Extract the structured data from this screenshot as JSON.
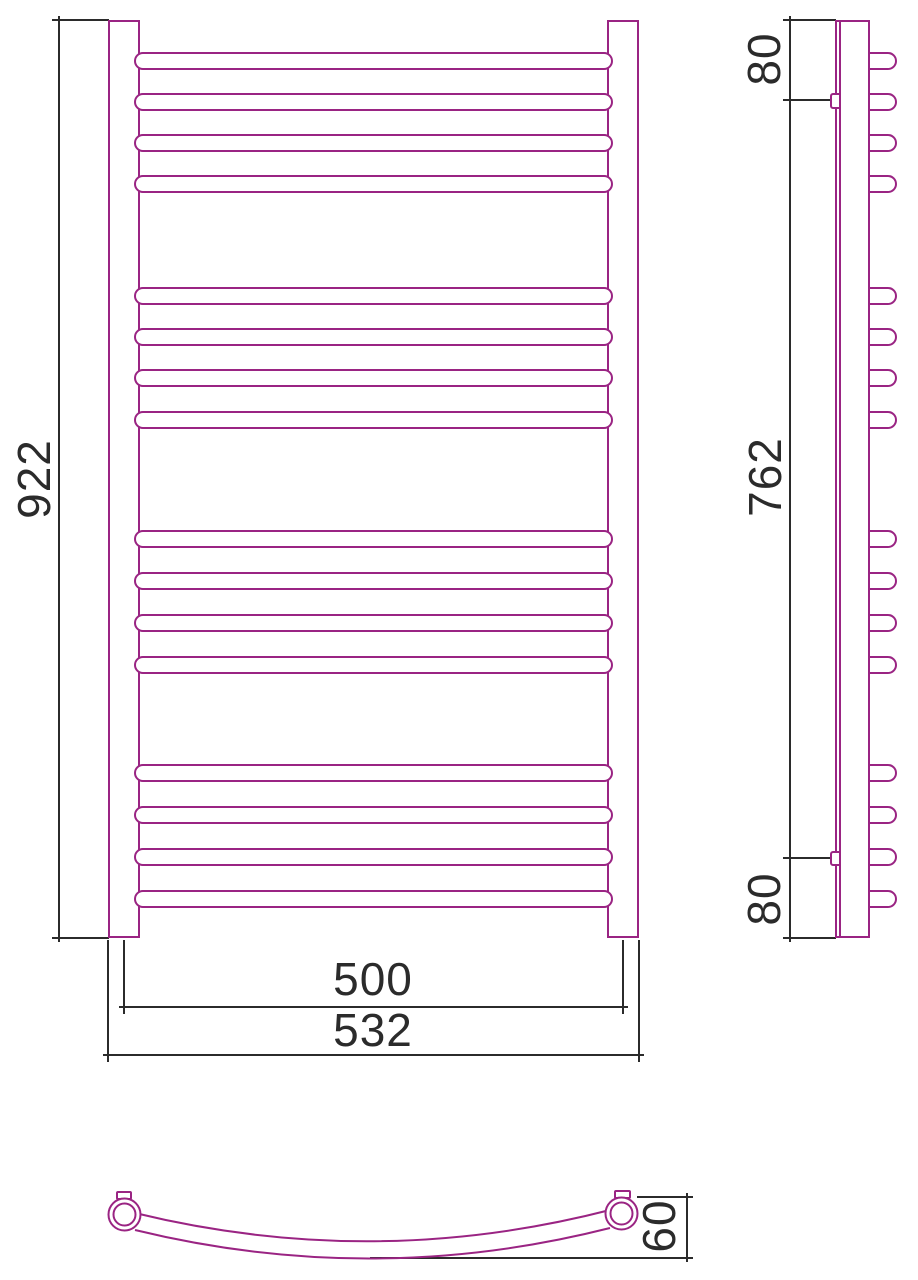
{
  "colors": {
    "line": "#9a2483",
    "dim": "#2b2b2b",
    "background": "#ffffff"
  },
  "dimensions": {
    "front": {
      "height": "922",
      "axis_width": "500",
      "overall_width": "532"
    },
    "side": {
      "top_bracket_offset": "80",
      "bracket_spacing": "762",
      "bottom_bracket_offset": "80"
    },
    "top": {
      "curve_depth": "60"
    }
  },
  "rails": {
    "count": 16,
    "group_size": 4,
    "bar_tops": [
      52,
      93,
      134,
      175,
      287,
      328,
      369,
      411,
      530,
      572,
      614,
      656,
      764,
      806,
      848,
      890
    ]
  }
}
